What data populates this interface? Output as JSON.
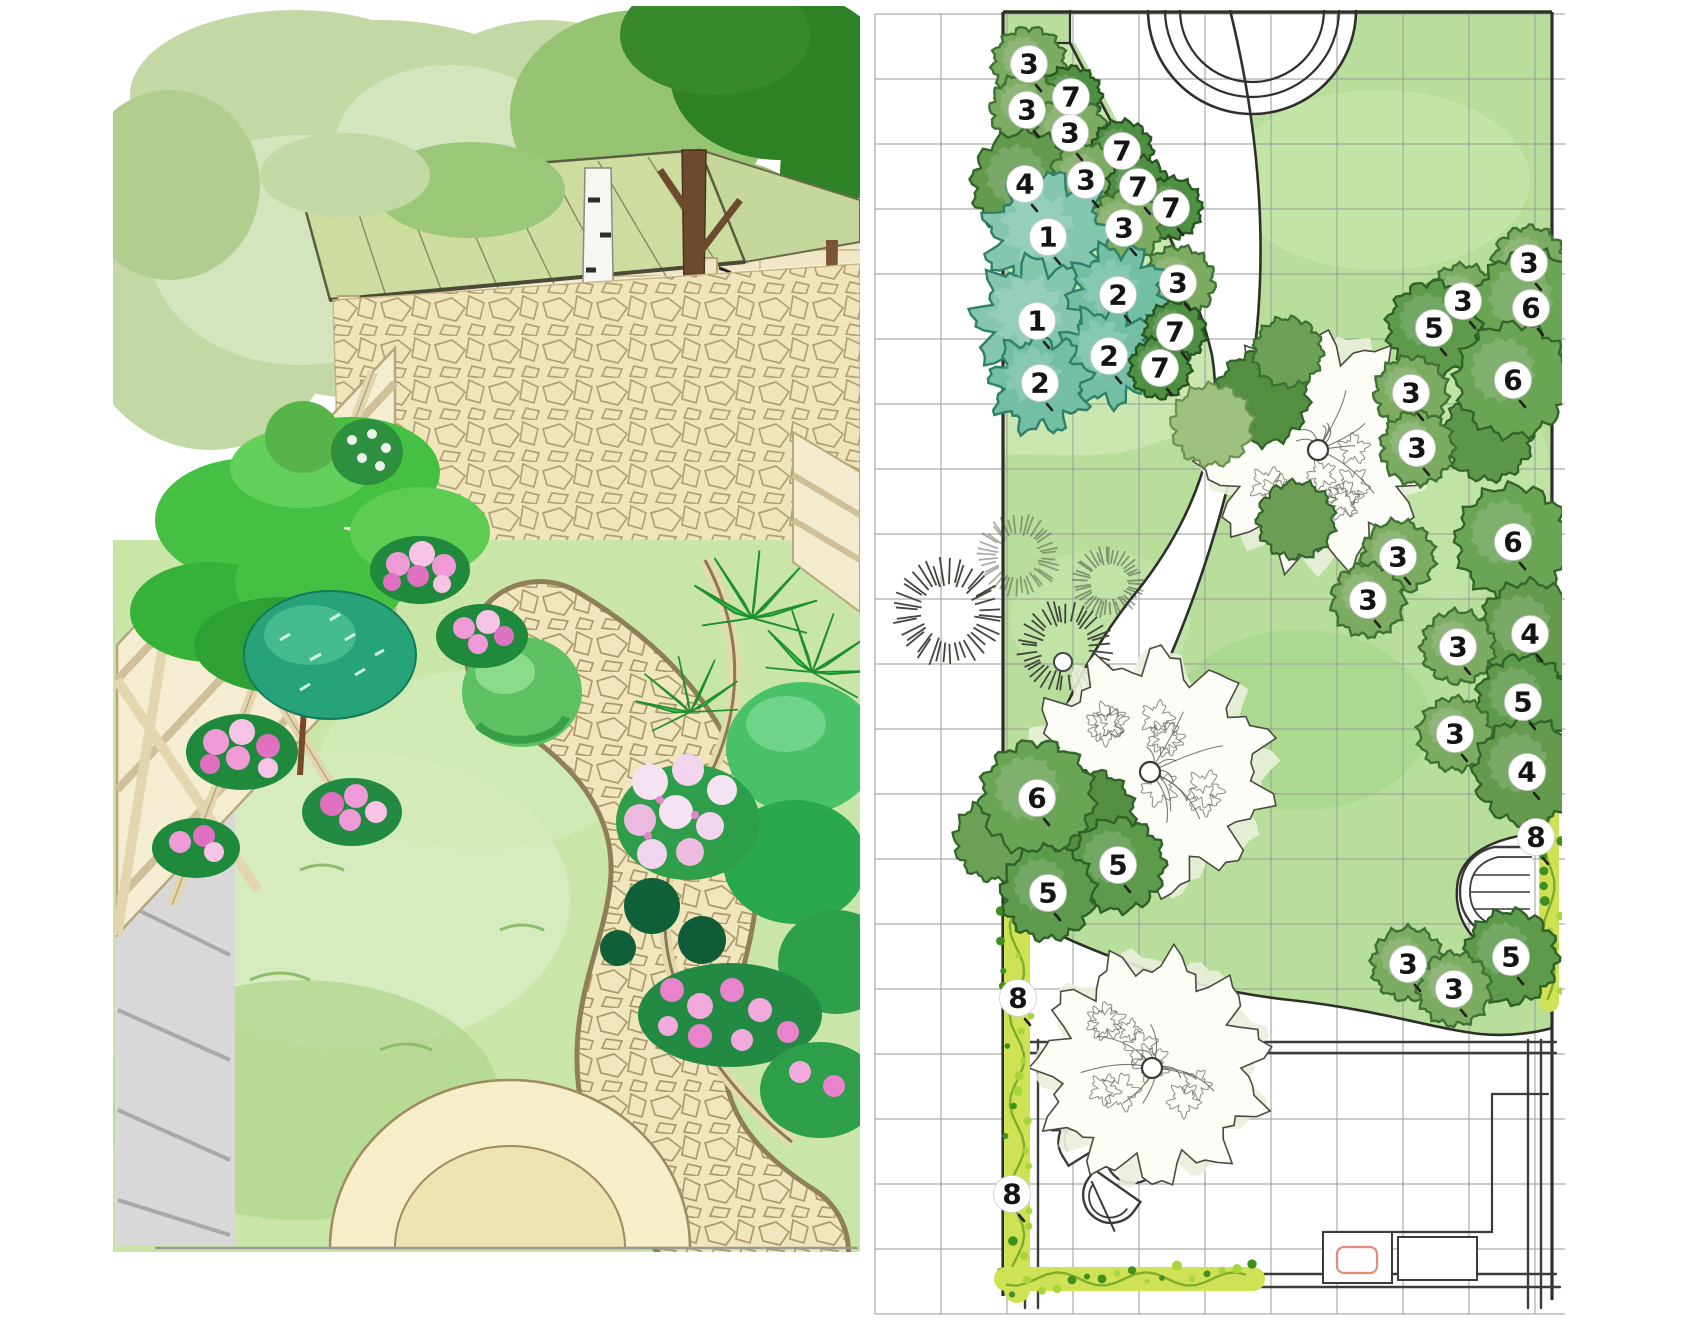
{
  "title": "Garden design: perspective sketch and planting plan",
  "plan": {
    "grid": {
      "x0": 875,
      "y0": 14,
      "dx": 66,
      "dy": 65,
      "x1": 1565,
      "y1": 1314,
      "color": "#9aa09a"
    },
    "colors": {
      "lawn": "#b7df9b",
      "lawn_light": "#cdeab4",
      "lawn_dark": "#a3d488",
      "bed": "#c9e7ae",
      "outline": "#2e2e2a",
      "structure": "#3c3c3c",
      "vine_base": "#cfe154",
      "vine_stem": "#7fae2a",
      "vine_leaf": "#3f8f1f",
      "badge": "#ffffff",
      "badge_text": "#141414",
      "accent_pink": "#e88a7a"
    },
    "marker_types": {
      "1": {
        "r": 58,
        "fill": "#85c7ae",
        "edge": "#2e806a",
        "kind": "spiky"
      },
      "2": {
        "r": 46,
        "fill": "#74bfa4",
        "edge": "#2e806a",
        "kind": "spiky"
      },
      "3": {
        "r": 36,
        "fill": "#7cab62",
        "edge": "#3f7233",
        "kind": "scallop"
      },
      "4": {
        "r": 52,
        "fill": "#649a4e",
        "edge": "#33652a",
        "kind": "scallop"
      },
      "5": {
        "r": 46,
        "fill": "#5d9a4b",
        "edge": "#2f6128",
        "kind": "scallop"
      },
      "6": {
        "r": 56,
        "fill": "#6aa455",
        "edge": "#33652a",
        "kind": "scallop"
      },
      "7": {
        "r": 30,
        "fill": "#4f8f43",
        "edge": "#27551f",
        "kind": "scallop"
      },
      "8": {
        "r": 0,
        "fill": "none",
        "edge": "none",
        "kind": "vine"
      }
    },
    "markers": [
      {
        "n": "3",
        "x": 1029,
        "y": 64
      },
      {
        "n": "7",
        "x": 1071,
        "y": 97
      },
      {
        "n": "3",
        "x": 1027,
        "y": 110
      },
      {
        "n": "3",
        "x": 1070,
        "y": 133
      },
      {
        "n": "7",
        "x": 1122,
        "y": 151
      },
      {
        "n": "4",
        "x": 1025,
        "y": 184
      },
      {
        "n": "3",
        "x": 1086,
        "y": 180
      },
      {
        "n": "7",
        "x": 1138,
        "y": 187
      },
      {
        "n": "7",
        "x": 1171,
        "y": 208
      },
      {
        "n": "3",
        "x": 1124,
        "y": 228
      },
      {
        "n": "3",
        "x": 1178,
        "y": 283
      },
      {
        "n": "1",
        "x": 1048,
        "y": 237
      },
      {
        "n": "1",
        "x": 1037,
        "y": 321
      },
      {
        "n": "2",
        "x": 1118,
        "y": 295
      },
      {
        "n": "2",
        "x": 1109,
        "y": 356
      },
      {
        "n": "2",
        "x": 1040,
        "y": 383
      },
      {
        "n": "7",
        "x": 1175,
        "y": 332
      },
      {
        "n": "7",
        "x": 1160,
        "y": 368
      },
      {
        "n": "3",
        "x": 1529,
        "y": 263
      },
      {
        "n": "3",
        "x": 1463,
        "y": 301
      },
      {
        "n": "6",
        "x": 1531,
        "y": 308
      },
      {
        "n": "5",
        "x": 1434,
        "y": 328
      },
      {
        "n": "6",
        "x": 1513,
        "y": 380
      },
      {
        "n": "3",
        "x": 1411,
        "y": 393
      },
      {
        "n": "3",
        "x": 1417,
        "y": 448
      },
      {
        "n": "6",
        "x": 1513,
        "y": 542
      },
      {
        "n": "3",
        "x": 1398,
        "y": 557
      },
      {
        "n": "3",
        "x": 1368,
        "y": 600
      },
      {
        "n": "4",
        "x": 1530,
        "y": 634
      },
      {
        "n": "3",
        "x": 1458,
        "y": 647
      },
      {
        "n": "5",
        "x": 1523,
        "y": 702
      },
      {
        "n": "3",
        "x": 1455,
        "y": 734
      },
      {
        "n": "4",
        "x": 1527,
        "y": 772
      },
      {
        "n": "6",
        "x": 1037,
        "y": 798
      },
      {
        "n": "5",
        "x": 1118,
        "y": 865
      },
      {
        "n": "5",
        "x": 1048,
        "y": 893
      },
      {
        "n": "8",
        "x": 1536,
        "y": 837
      },
      {
        "n": "5",
        "x": 1511,
        "y": 957
      },
      {
        "n": "3",
        "x": 1408,
        "y": 964
      },
      {
        "n": "3",
        "x": 1454,
        "y": 989
      },
      {
        "n": "8",
        "x": 1018,
        "y": 998
      },
      {
        "n": "8",
        "x": 1012,
        "y": 1194
      }
    ],
    "extra_blobs": [
      {
        "x": 1262,
        "y": 398,
        "r": 46,
        "fill": "#548e41",
        "edge": "#2f6128"
      },
      {
        "x": 1212,
        "y": 425,
        "r": 40,
        "fill": "#9dc17f",
        "edge": "#6a9150"
      },
      {
        "x": 1288,
        "y": 352,
        "r": 34,
        "fill": "#6da057",
        "edge": "#3a7030"
      },
      {
        "x": 1296,
        "y": 520,
        "r": 38,
        "fill": "#6b9e54",
        "edge": "#33652a"
      },
      {
        "x": 1488,
        "y": 436,
        "r": 44,
        "fill": "#5c964a",
        "edge": "#2f6128"
      },
      {
        "x": 1090,
        "y": 815,
        "r": 44,
        "fill": "#548e41",
        "edge": "#2c5f26"
      },
      {
        "x": 995,
        "y": 840,
        "r": 40,
        "fill": "#6da057",
        "edge": "#33652a"
      }
    ],
    "grasses": [
      {
        "x": 948,
        "y": 612,
        "r": 52,
        "o": 1
      },
      {
        "x": 1018,
        "y": 556,
        "r": 40,
        "o": 0.45
      },
      {
        "x": 1065,
        "y": 648,
        "r": 46,
        "o": 1
      },
      {
        "x": 1108,
        "y": 582,
        "r": 34,
        "o": 0.5
      }
    ],
    "grass_dot": {
      "x": 1063,
      "y": 662,
      "r": 9
    },
    "sketch_trees": [
      {
        "x": 1318,
        "y": 450,
        "r": 108
      },
      {
        "x": 1150,
        "y": 772,
        "r": 112
      },
      {
        "x": 1152,
        "y": 1068,
        "r": 106
      }
    ],
    "vines": [
      {
        "x1": 1017,
        "y1": 905,
        "x2": 1017,
        "y2": 1290,
        "w": 26
      },
      {
        "x1": 1006,
        "y1": 1279,
        "x2": 1253,
        "y2": 1279,
        "w": 24
      },
      {
        "x1": 1549,
        "y1": 760,
        "x2": 1549,
        "y2": 1002,
        "w": 20
      }
    ]
  }
}
